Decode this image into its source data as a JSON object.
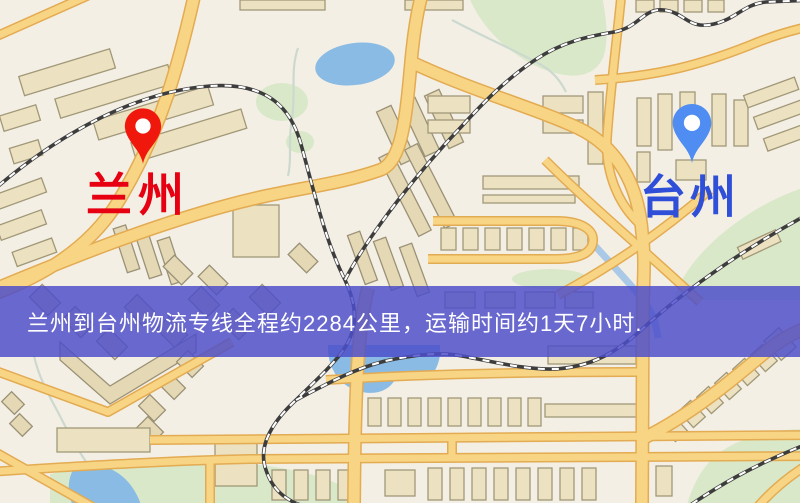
{
  "map": {
    "banner": {
      "text": "兰州到台州物流专线全程约2284公里，运输时间约1天7小时.",
      "bg_color": "#4c4ec9",
      "text_color": "#ffffff"
    },
    "markers": [
      {
        "name": "兰州",
        "pin_color": "#f0170c",
        "label_color": "#e60012"
      },
      {
        "name": "台州",
        "pin_color": "#4f8df2",
        "label_color": "#2f4fd8"
      }
    ],
    "legend_colors": {
      "background": "#f4efe5",
      "road": "#f6cf6e",
      "railway": "#3d3d3d",
      "water": "#8abbe4",
      "park": "#d9e8c8",
      "building": "#ebe0bf"
    }
  }
}
